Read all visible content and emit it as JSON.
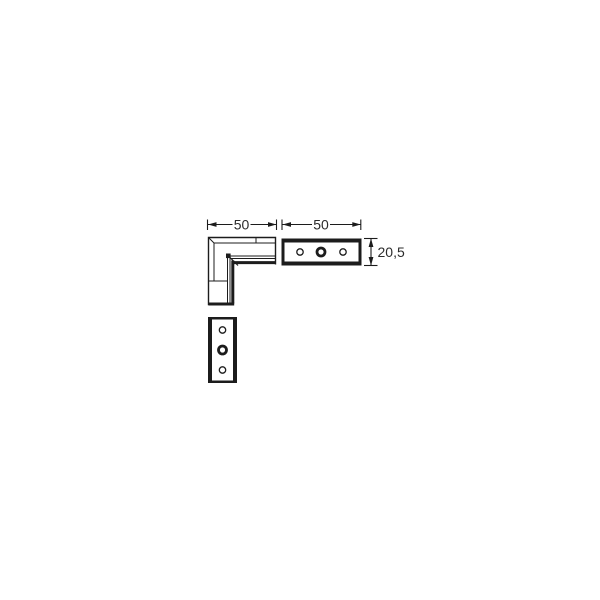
{
  "canvas": {
    "background": "#ffffff",
    "width": 600,
    "height": 600
  },
  "drawing": {
    "type": "technical-line-drawing",
    "subject": "90-degree corner connector profile with two drilled flat plates",
    "line_color": "#1c1c1c",
    "text_color": "#2b2b2b",
    "views": [
      {
        "id": "corner-front-view",
        "desc": "L-shaped mitred corner profile"
      },
      {
        "id": "top-plate-side-view",
        "desc": "horizontal plate, 3 holes"
      },
      {
        "id": "bottom-plate-view",
        "desc": "vertical plate, 3 holes"
      }
    ],
    "dimensions": [
      {
        "id": "corner-width",
        "label": "50"
      },
      {
        "id": "plate-width",
        "label": "50"
      },
      {
        "id": "plate-height",
        "label": "20,5"
      }
    ]
  }
}
